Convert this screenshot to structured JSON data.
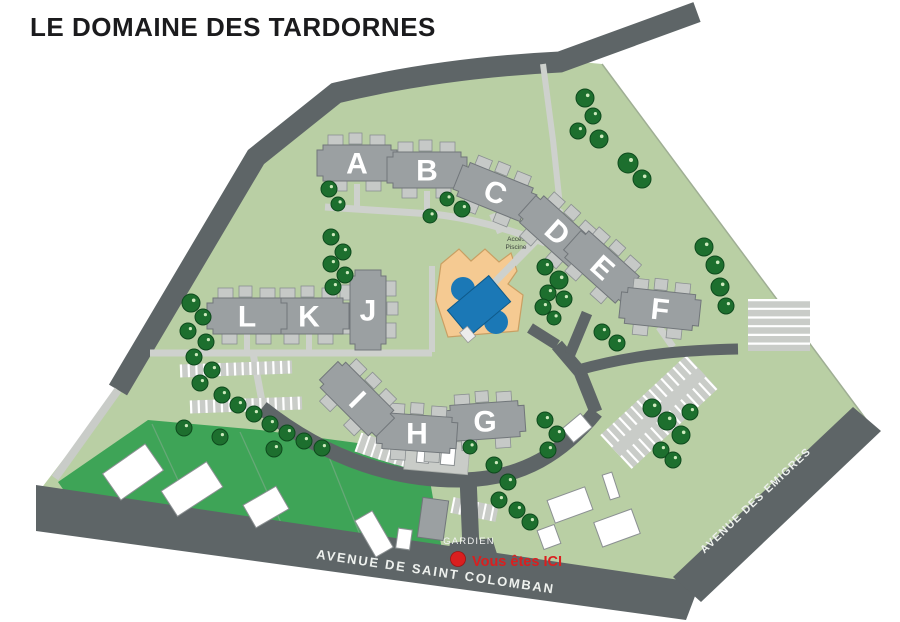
{
  "title": "LE DOMAINE DES TARDORNES",
  "map": {
    "buildings": [
      {
        "label": "A"
      },
      {
        "label": "B"
      },
      {
        "label": "C"
      },
      {
        "label": "D"
      },
      {
        "label": "E"
      },
      {
        "label": "F"
      },
      {
        "label": "G"
      },
      {
        "label": "H"
      },
      {
        "label": "I"
      },
      {
        "label": "J"
      },
      {
        "label": "K"
      },
      {
        "label": "L"
      }
    ],
    "pool": {
      "access_label_line1": "Accès",
      "access_label_line2": "Piscine"
    },
    "guard": {
      "label": "GARDIEN"
    },
    "marker": {
      "label": "Vous êtes ICI"
    },
    "streets": [
      {
        "name": "AVENUE DE SAINT COLOMBAN"
      },
      {
        "name": "AVENUE DES EMIGRES"
      }
    ],
    "colors": {
      "domain_green": "#b9cfa4",
      "parcel_green": "#3ea457",
      "road_dark": "#5e6567",
      "path_light": "#ced1cd",
      "building_gray": "#9ba0a2",
      "building_light": "#c6c9c7",
      "tree_green": "#1d6f2e",
      "pool_sand": "#f5ca92",
      "pool_blue": "#1b78b6",
      "marker_red": "#da1f1f"
    }
  }
}
